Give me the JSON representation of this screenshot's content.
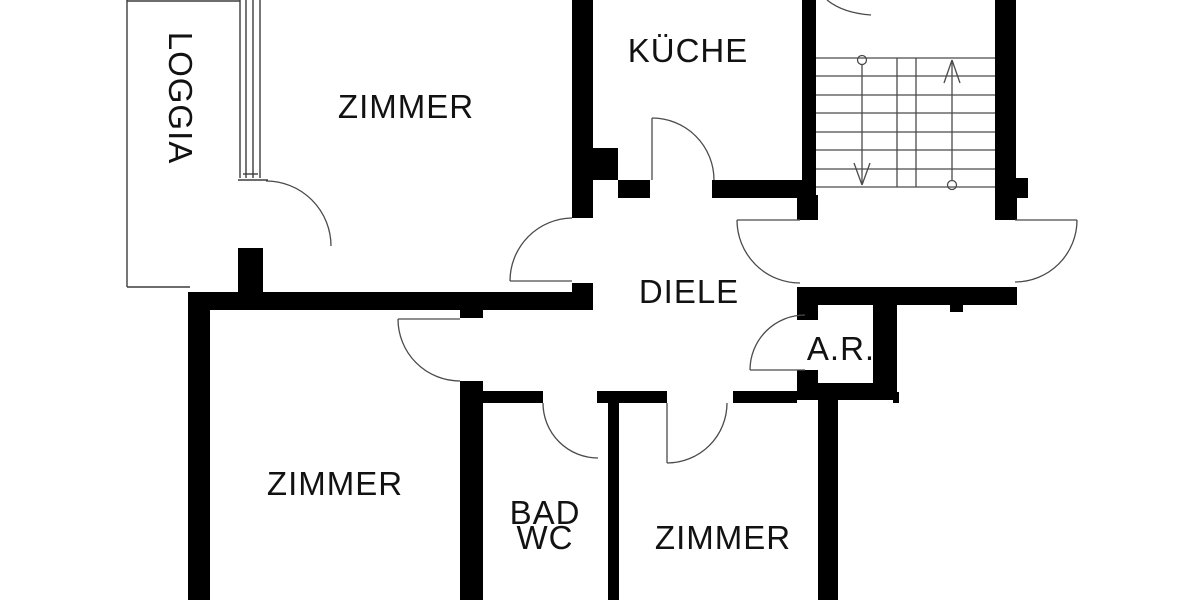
{
  "floorplan": {
    "background_color": "#ffffff",
    "wall_color": "#000000",
    "line_color": "#3d3d3d",
    "labels": {
      "loggia": "LOGGIA",
      "zimmer_top_left": "ZIMMER",
      "kueche": "KÜCHE",
      "diele": "DIELE",
      "abstellraum": "A.R.",
      "zimmer_bottom_left": "ZIMMER",
      "bad": "BAD",
      "wc": "WC",
      "zimmer_bottom_right": "ZIMMER"
    }
  }
}
